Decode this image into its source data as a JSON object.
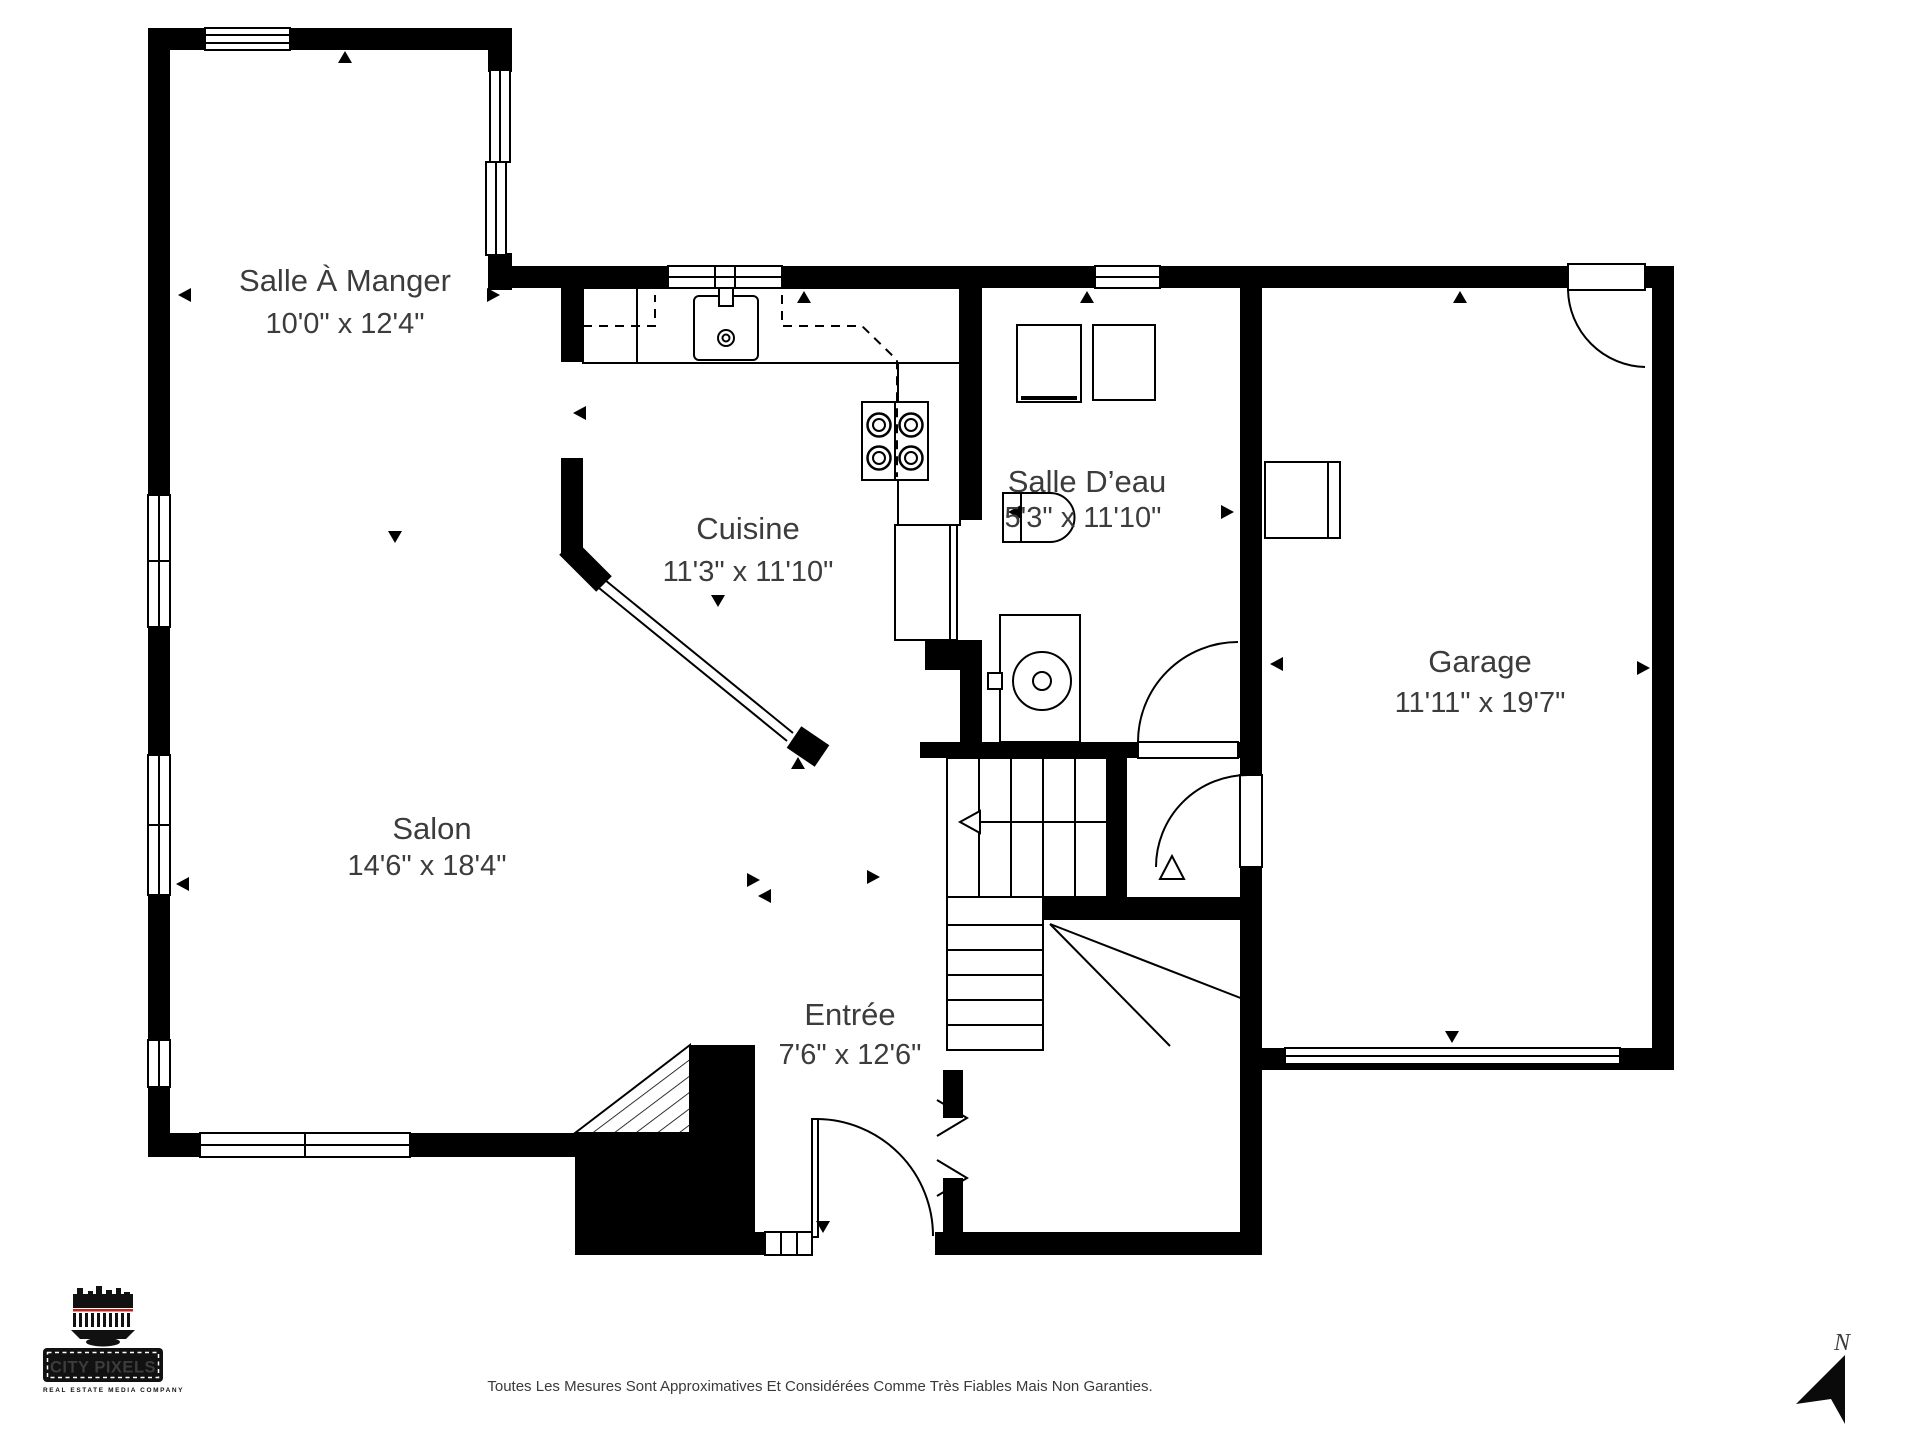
{
  "rooms": [
    {
      "name": "Salle À Manger",
      "dims": "10'0\" x 12'4\""
    },
    {
      "name": "Cuisine",
      "dims": "11'3\" x 11'10\""
    },
    {
      "name": "Salle D’eau",
      "dims": "5'3\" x 11'10\""
    },
    {
      "name": "Garage",
      "dims": "11'11\" x 19'7\""
    },
    {
      "name": "Salon",
      "dims": "14'6\" x 18'4\""
    },
    {
      "name": "Entrée",
      "dims": "7'6\" x 12'6\""
    }
  ],
  "footer": {
    "disclaimer": "Toutes Les Mesures Sont Approximatives Et Considérées Comme Très Fiables Mais Non Garanties."
  },
  "logo": {
    "title": "CITY PIXELS",
    "tagline": "REAL ESTATE MEDIA COMPANY"
  },
  "compass": {
    "label": "N"
  },
  "colors": {
    "wall": "#000000",
    "text": "#3c3c3c",
    "logo_red": "#c0231d"
  }
}
